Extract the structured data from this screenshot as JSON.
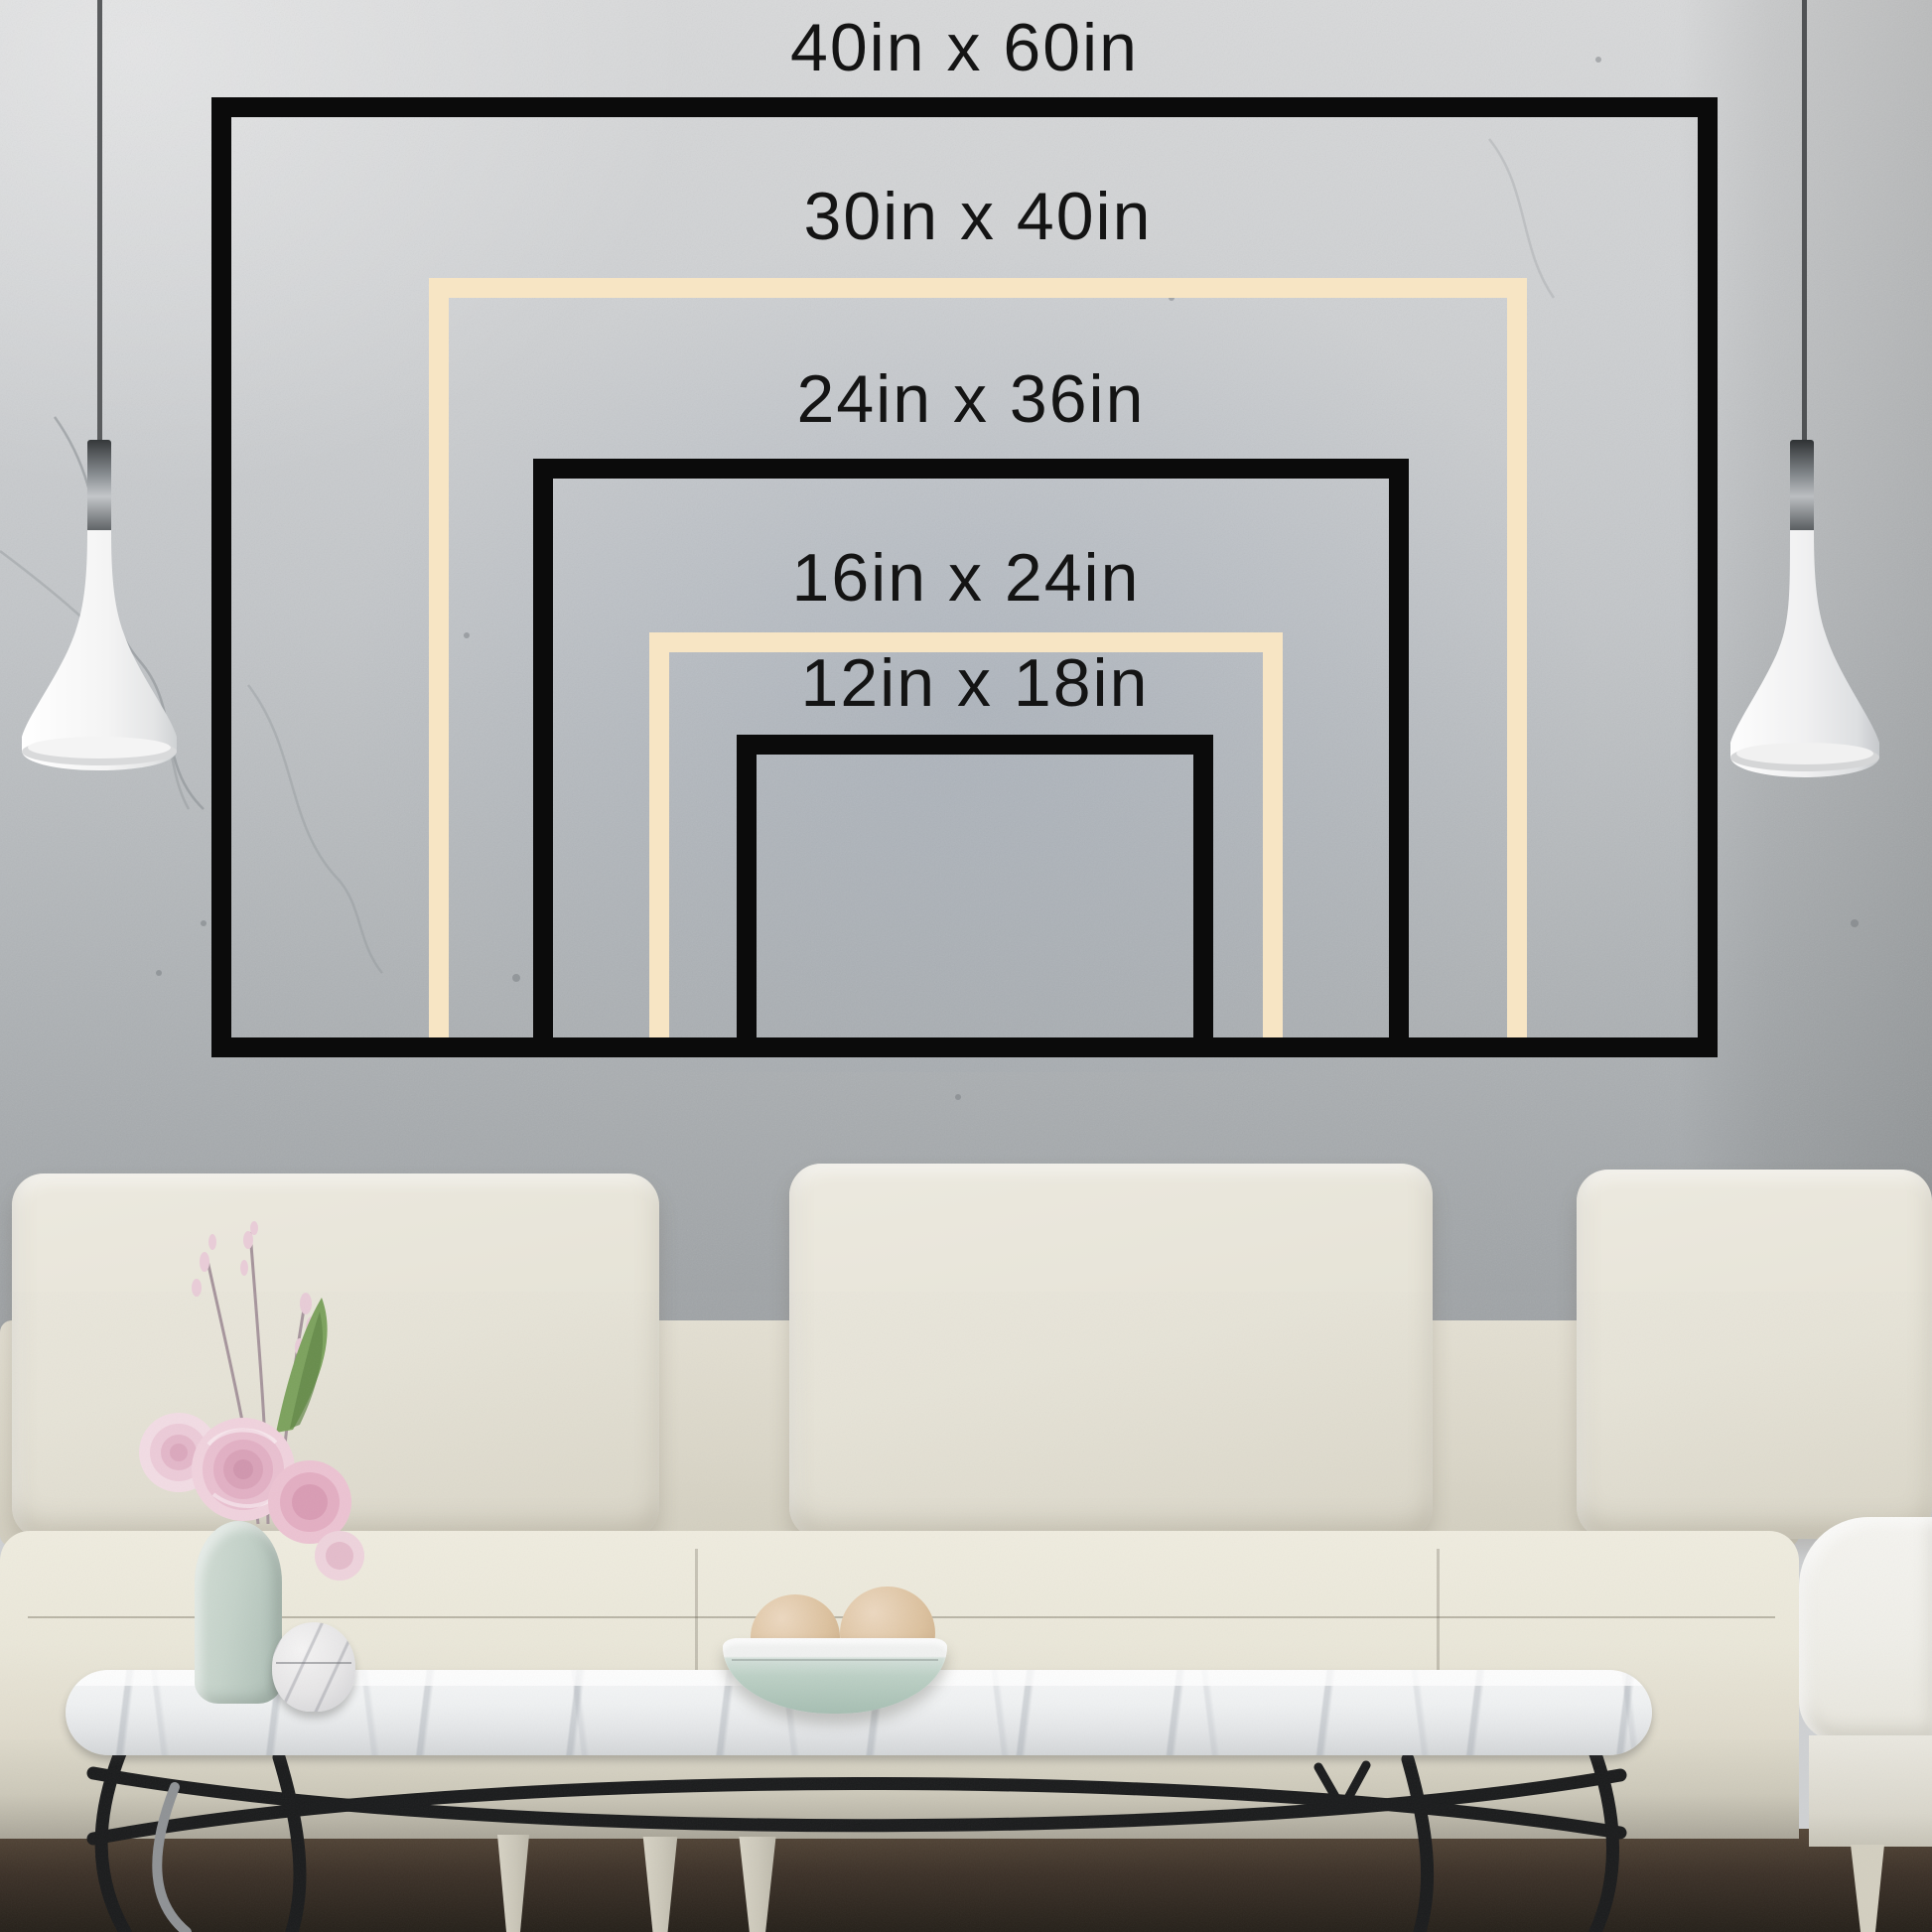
{
  "title": "Canvas size comparison chart on living-room wall",
  "sizes": [
    {
      "label": "40in x 60in",
      "width_in": 40,
      "height_in": 60,
      "frame_color": "black"
    },
    {
      "label": "30in x 40in",
      "width_in": 30,
      "height_in": 40,
      "frame_color": "cream"
    },
    {
      "label": "24in x 36in",
      "width_in": 24,
      "height_in": 36,
      "frame_color": "black"
    },
    {
      "label": "16in x 24in",
      "width_in": 16,
      "height_in": 24,
      "frame_color": "cream"
    },
    {
      "label": "12in x 18in",
      "width_in": 12,
      "height_in": 18,
      "frame_color": "black"
    }
  ],
  "colors": {
    "frame_black": "#0b0b0b",
    "frame_cream": "#f7e5c4",
    "label_text": "#141414",
    "wall_gray": "#c3c6c9",
    "sofa_cream": "#e6e3d7",
    "floor_brown": "#3b3027",
    "bowl_mint": "#bcd0c5",
    "flower_pink": "#e9c0d0"
  },
  "scene": {
    "elements": [
      "concrete-wall",
      "pendant-lamp-left",
      "pendant-lamp-right",
      "sofa",
      "armchair",
      "coffee-table",
      "flower-vase",
      "marble-jar",
      "decor-bowl",
      "wood-floor"
    ]
  }
}
